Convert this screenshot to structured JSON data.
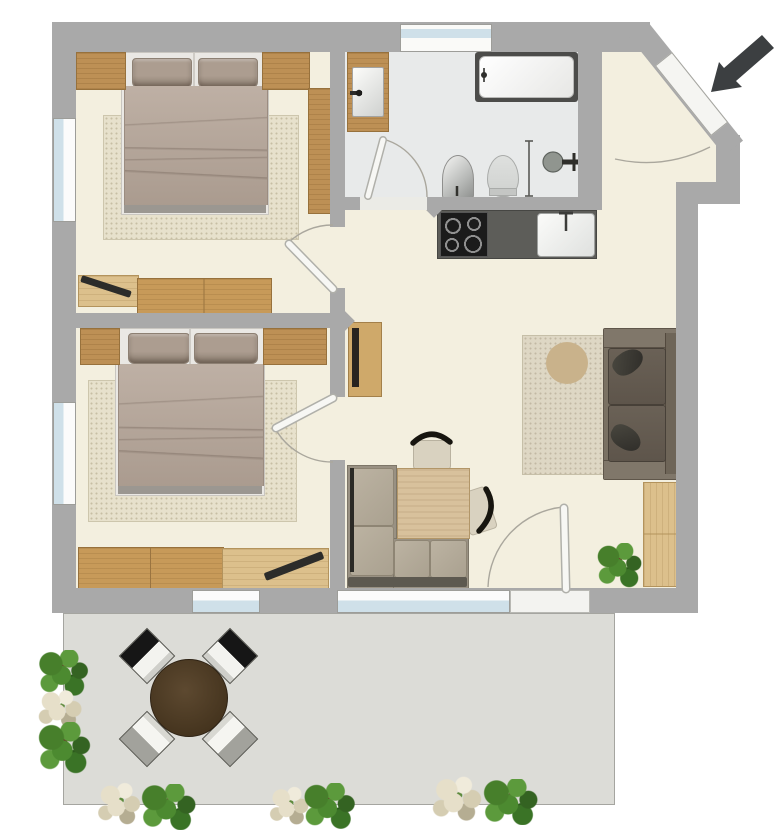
{
  "document": {
    "type": "apartment-floor-plan",
    "view": "top-down",
    "background": "#ffffff"
  },
  "palette": {
    "wall": "#a9a9a9",
    "room_floor": "#f3efdf",
    "bathroom_floor": "#e8eaea",
    "terrace_floor": "#dcdcd7",
    "wood_dark": "#bd9055",
    "wood_light": "#dcc08c",
    "bed_duvet": "#b5a598",
    "pillow": "#a29183",
    "rug": "#e7e1cc",
    "sofa": "#7a7163",
    "kitchen_counter": "#5d5d59",
    "cooktop": "#1b1b1b",
    "window_glass": "#cfe0e9",
    "door_leaf": "#f5f5f2",
    "entrance_arrow": "#3c3f41",
    "plant_green": "#4a8a31",
    "terrace_table": "#46351f"
  },
  "rooms": [
    {
      "id": "bedroom-1",
      "position": "top-left",
      "furniture": [
        "double-bed",
        "pillow-left",
        "pillow-right",
        "nightstand-left",
        "nightstand-right",
        "tall-cabinet",
        "rug",
        "dresser",
        "wardrobe",
        "decor-bar"
      ],
      "windows": [
        "left-wall"
      ],
      "doors": [
        "east-wall-swing-door"
      ]
    },
    {
      "id": "bathroom",
      "position": "top-middle",
      "fixtures": [
        "vanity-with-sink",
        "bathtub",
        "bidet",
        "toilet",
        "towel-rail",
        "shower-head"
      ],
      "windows": [
        "top-wall"
      ],
      "doors": [
        "south-swing-door"
      ]
    },
    {
      "id": "entry-hall",
      "position": "top-right",
      "doors": [
        "diagonal-entrance-door"
      ],
      "annotation": "entrance-arrow pointing down-left"
    },
    {
      "id": "kitchen",
      "position": "center",
      "fixtures": [
        "counter",
        "cooktop-4-burners",
        "kitchen-sink"
      ]
    },
    {
      "id": "living-dining",
      "position": "center-right",
      "furniture": [
        "sofa",
        "sofa-pillow-top",
        "sofa-pillow-bottom",
        "rug-with-circle-motif",
        "sideboard",
        "tv-board",
        "dining-table",
        "dining-chair-top",
        "dining-chair-right",
        "corner-bench",
        "potted-plant"
      ],
      "windows": [
        "bottom-wall"
      ],
      "doors": [
        "terrace-swing-door"
      ]
    },
    {
      "id": "bedroom-2",
      "position": "bottom-left",
      "furniture": [
        "double-bed",
        "pillow-left",
        "pillow-right",
        "nightstand-left",
        "dresser-right",
        "rug",
        "wardrobe",
        "desk",
        "decor-bar"
      ],
      "windows": [
        "left-wall",
        "bottom-wall"
      ],
      "doors": [
        "east-wall-swing-door"
      ]
    },
    {
      "id": "terrace",
      "position": "bottom",
      "furniture": [
        "round-dining-table",
        "terrace-chair-nw",
        "terrace-chair-ne",
        "terrace-chair-sw",
        "terrace-chair-se"
      ],
      "plants": [
        "left-column-3-clusters",
        "bottom-row-3-groups"
      ]
    }
  ],
  "entrance_arrow": {
    "color": "#3c3f41",
    "direction": "down-left",
    "position": "outside-top-right"
  }
}
